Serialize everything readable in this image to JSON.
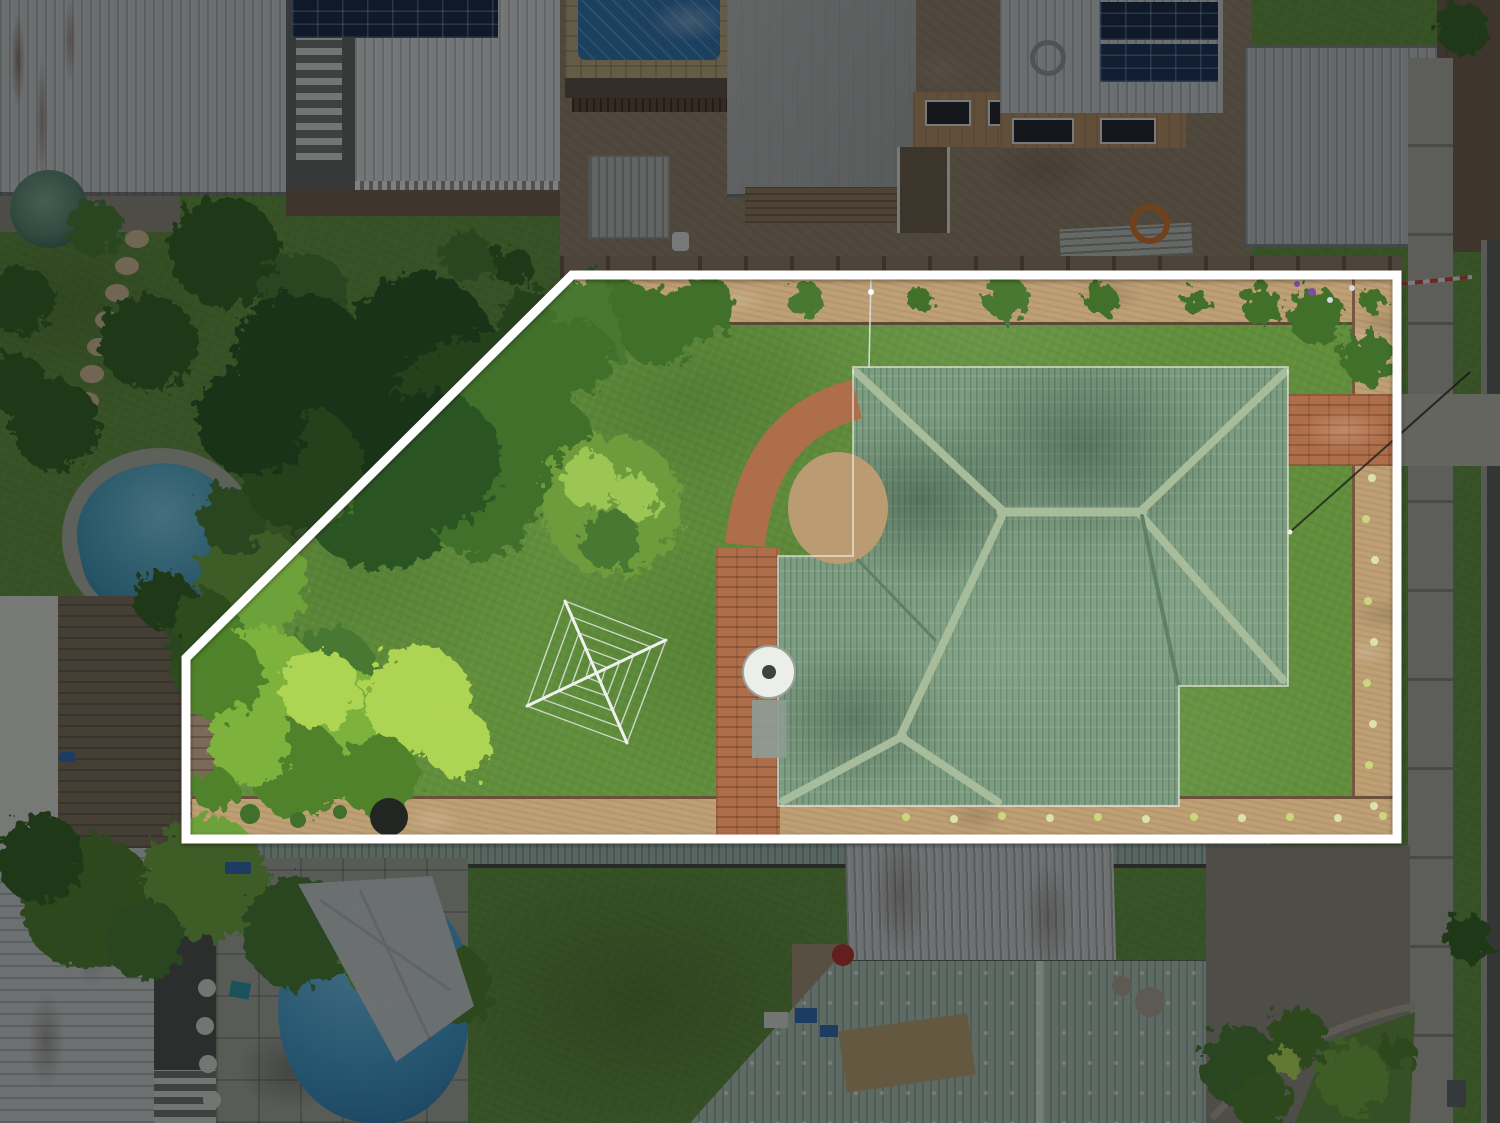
{
  "scene": {
    "type": "aerial-drone-photograph",
    "subject": "top-down real-estate aerial of a suburban lot outlined in white; large lawn with trees, rotary clothesline, green tiled hip-roof house, brick paths, neighbouring houses, two swimming pools, footpath and road at right; area outside the outline is dimmed"
  },
  "canvas": {
    "width": 1500,
    "height": 1123
  },
  "palette": {
    "boundary_white": "#ffffff",
    "dim": "rgba(7,10,14,0.46)",
    "lawn_base": "#618f3c",
    "canopy_dark": "#2c5420",
    "canopy_mid": "#41702c",
    "tree_round": "#6e9c3e",
    "tree_hl": "#9cc653",
    "bush_bright": "#7db23e",
    "bush_hl": "#aed452",
    "bush_mid": "#4f8229",
    "palm_dark": "#355f22",
    "palm_mid": "#487831",
    "veg_bright_out": "#6da23a",
    "veg_mid_out": "#4e7c2c",
    "roof_tile": "#7d9d81",
    "roof_ridge": "#a6bc9b",
    "roof_valley": "#5e8068",
    "white_roof_a": "#c0c2c3",
    "white_roof_b": "#cfd1d1",
    "white_roof_weathered": "#c4c6c6",
    "gray_roof": "#a8a9a7",
    "shed_gray": "#b4b8b8",
    "green_roof_pale": "#a8bcae",
    "carport_green": "#9db3a7",
    "solar_dark": "#18253f",
    "solar_line": "rgba(130,160,215,0.45)",
    "brick": "#ae6e4a",
    "mulch": "#bfa075",
    "dirt": "#8f7c64",
    "dirt_dark": "#6e5c48",
    "concrete": "#a6a399",
    "concrete_light": "#b5b2a7",
    "pavers": "#9fa096",
    "road": "#5c5c59",
    "curb": "#a09e95",
    "pool_teal_hi": "#79c4dc",
    "pool_teal": "#3f93b2",
    "pool_blue_hi": "#6fc0e4",
    "pool_blue": "#3c8fc0",
    "tarp_blue": "#2e6ea6",
    "deck_wood": "#7a6a57",
    "wall_white": "#d6d6d1",
    "tank_green": "#55806c",
    "timber_tan": "#b08a60",
    "window_dark": "#20242a",
    "fence_brown": "#8a7660",
    "sail_gray": "#c3c6c7",
    "clothesline": "#dfe5e1",
    "dish_white": "#eceeea",
    "orange": "#cc6f2a",
    "tape_red": "#c23b30",
    "stone_edge": "#a79e8e",
    "bbq_dark": "#232523",
    "flower_a": "#dce3a8",
    "flower_b": "#cbd67e",
    "flower_purple": "#7a4f9e",
    "flower_white": "#d9dade",
    "stone_tan": "#c9b48e",
    "pot_white": "#cfd0ca",
    "blue_item": "#2f66a8",
    "red_item": "#b03028"
  },
  "boundary": {
    "points": "572,275 1397,275 1397,839 186,839 186,658",
    "dim_path": "M0,0 H1500 V1123 H0 Z M572,275 L1397,275 L1397,839 L186,839 L186,658 Z"
  },
  "house_roof": {
    "gutter_points": "853,367 1288,367 1288,686 1179,686 1179,806 778,806 778,556 853,556"
  },
  "clothesline": {
    "outer": "565,601 666,640 627,743 527,706",
    "ring1": "572,617 651,647 620,727 542,699",
    "ring2": "579,633 634,654 613,711 558,691",
    "ring3": "585,648 620,661 607,696 572,684",
    "ring4": "591,661 606,667 601,683 586,677",
    "arm1": "M565,601 L627,743",
    "arm2": "M527,706 L666,640"
  },
  "paths": {
    "brick_curve": "M857,399 Q757,424 745,545",
    "stone_edge": "M1212,1118 Q1292,1030 1415,1006",
    "lawn_wedge": "1295,1123 1327,1043 1415,1012 1410,1123",
    "sail": "298,884 432,876 474,1006 396,1062",
    "wire_pole": "M871,276 L869,368",
    "wire_power": "M1290,532 L1470,372",
    "tape": "M1400,284 L1472,277"
  },
  "generated": [
    {
      "target": "#g-stones",
      "name": "stepping-stone",
      "shape": "ellipse",
      "attrs": [
        "cx",
        "cy",
        "rx",
        "ry",
        "fill"
      ],
      "items": [
        [
          137,
          239,
          12,
          9,
          "stone_tan"
        ],
        [
          127,
          266,
          12,
          9,
          "stone_tan"
        ],
        [
          117,
          293,
          12,
          9,
          "stone_tan"
        ],
        [
          107,
          320,
          12,
          9,
          "stone_tan"
        ],
        [
          99,
          347,
          12,
          9,
          "stone_tan"
        ],
        [
          92,
          374,
          12,
          9,
          "stone_tan"
        ],
        [
          87,
          401,
          12,
          9,
          "stone_tan"
        ],
        [
          84,
          428,
          12,
          9,
          "stone_tan"
        ]
      ]
    },
    {
      "target": "#g-veg",
      "name": "tree-canopy",
      "shape": "circle",
      "attrs": [
        "cx",
        "cy",
        "r",
        "fill"
      ],
      "items": [
        [
          225,
          252,
          55,
          "palm_dark"
        ],
        [
          305,
          298,
          45,
          "palm_mid"
        ],
        [
          148,
          342,
          48,
          "palm_dark"
        ],
        [
          55,
          425,
          45,
          "palm_dark"
        ],
        [
          95,
          228,
          28,
          "palm_mid"
        ],
        [
          20,
          300,
          34,
          "palm_dark"
        ],
        [
          15,
          382,
          30,
          "palm_dark"
        ],
        [
          468,
          258,
          26,
          "palm_mid"
        ],
        [
          512,
          266,
          20,
          "palm_dark"
        ],
        [
          252,
          582,
          55,
          "veg_bright_out"
        ],
        [
          330,
          672,
          46,
          "palm_mid"
        ],
        [
          205,
          638,
          40,
          "palm_mid"
        ],
        [
          232,
          520,
          34,
          "palm_mid"
        ],
        [
          165,
          600,
          30,
          "palm_dark"
        ],
        [
          88,
          902,
          68,
          "veg_mid_out"
        ],
        [
          205,
          878,
          62,
          "veg_bright_out"
        ],
        [
          298,
          933,
          56,
          "palm_mid"
        ],
        [
          388,
          952,
          50,
          "veg_bright_out"
        ],
        [
          452,
          986,
          40,
          "veg_mid_out"
        ],
        [
          40,
          858,
          44,
          "palm_dark"
        ],
        [
          145,
          940,
          40,
          "palm_mid"
        ],
        [
          1468,
          938,
          24,
          "palm_dark"
        ],
        [
          1462,
          28,
          26,
          "palm_dark"
        ],
        [
          1240,
          1066,
          40,
          "palm_mid"
        ],
        [
          1298,
          1038,
          30,
          "veg_mid_out"
        ],
        [
          1352,
          1078,
          36,
          "veg_bright_out"
        ],
        [
          1262,
          1100,
          30,
          "veg_mid_out"
        ],
        [
          1286,
          1062,
          14,
          "bush_hl"
        ],
        [
          1398,
          1052,
          16,
          "veg_mid_out"
        ],
        [
          360,
          418,
          88,
          "canopy_dark"
        ],
        [
          300,
          360,
          68,
          "canopy_dark"
        ],
        [
          420,
          348,
          74,
          "canopy_dark"
        ],
        [
          468,
          418,
          78,
          "canopy_mid"
        ],
        [
          380,
          488,
          82,
          "canopy_dark"
        ],
        [
          300,
          468,
          62,
          "canopy_mid"
        ],
        [
          252,
          420,
          55,
          "canopy_dark"
        ],
        [
          520,
          378,
          58,
          "canopy_mid"
        ],
        [
          545,
          448,
          52,
          "canopy_mid"
        ],
        [
          482,
          500,
          58,
          "canopy_mid"
        ],
        [
          430,
          460,
          70,
          "canopy_dark"
        ],
        [
          540,
          330,
          42,
          "canopy_mid"
        ],
        [
          600,
          318,
          48,
          "palm_mid"
        ],
        [
          658,
          328,
          38,
          "canopy_mid"
        ],
        [
          578,
          356,
          36,
          "canopy_mid"
        ],
        [
          700,
          310,
          30,
          "canopy_mid"
        ],
        [
          612,
          505,
          70,
          "tree_round"
        ],
        [
          590,
          480,
          28,
          "tree_hl"
        ],
        [
          636,
          496,
          22,
          "tree_hl"
        ],
        [
          610,
          540,
          30,
          "palm_mid"
        ],
        [
          262,
          688,
          60,
          "bush_bright"
        ],
        [
          340,
          733,
          66,
          "bush_bright"
        ],
        [
          418,
          700,
          54,
          "bush_hl"
        ],
        [
          298,
          770,
          48,
          "bush_mid"
        ],
        [
          218,
          675,
          44,
          "bush_mid"
        ],
        [
          378,
          776,
          40,
          "bush_mid"
        ],
        [
          458,
          743,
          34,
          "bush_hl"
        ],
        [
          250,
          745,
          40,
          "bush_bright"
        ],
        [
          205,
          622,
          32,
          "bush_mid"
        ],
        [
          320,
          690,
          40,
          "bush_hl"
        ],
        [
          215,
          790,
          22,
          "bush_mid"
        ],
        [
          628,
          300,
          20,
          "canopy_mid"
        ],
        [
          718,
          296,
          14,
          "canopy_mid"
        ],
        [
          806,
          300,
          18,
          "palm_mid"
        ],
        [
          920,
          300,
          12,
          "canopy_mid"
        ],
        [
          1006,
          298,
          22,
          "palm_mid"
        ],
        [
          1102,
          300,
          16,
          "canopy_mid"
        ],
        [
          1196,
          302,
          13,
          "canopy_mid"
        ],
        [
          1262,
          306,
          20,
          "canopy_mid"
        ],
        [
          1316,
          316,
          28,
          "canopy_mid"
        ],
        [
          1368,
          358,
          26,
          "canopy_mid"
        ],
        [
          1372,
          300,
          12,
          "canopy_mid"
        ]
      ]
    },
    {
      "target": "#g-ridges",
      "name": "roof-ridge",
      "shape": "path",
      "attrs": [
        "d",
        "stroke",
        "stroke-width"
      ],
      "items": [
        [
          "M856,372 L1004,512",
          "roof_ridge",
          8
        ],
        [
          "M1285,372 L1140,512",
          "roof_ridge",
          8
        ],
        [
          "M1001,512 L1143,512",
          "roof_ridge",
          9
        ],
        [
          "M1140,514 L1283,680",
          "roof_ridge",
          8
        ],
        [
          "M1003,514 L901,735",
          "roof_ridge",
          8
        ],
        [
          "M903,736 L783,801",
          "roof_ridge",
          8
        ],
        [
          "M901,737 L998,802",
          "roof_ridge",
          8
        ],
        [
          "M1142,516 L1178,684",
          "roof_valley",
          4
        ],
        [
          "M858,560 L935,640",
          "roof_valley",
          3
        ]
      ]
    },
    {
      "target": "#g-flowers",
      "name": "garden-flower",
      "shape": "circle",
      "attrs": [
        "cx",
        "cy",
        "r",
        "fill"
      ],
      "items": [
        [
          1372,
          478,
          4,
          "flower_a"
        ],
        [
          1366,
          519,
          4,
          "flower_b"
        ],
        [
          1375,
          560,
          4,
          "flower_a"
        ],
        [
          1368,
          601,
          4,
          "flower_b"
        ],
        [
          1374,
          642,
          4,
          "flower_a"
        ],
        [
          1367,
          683,
          4,
          "flower_b"
        ],
        [
          1373,
          724,
          4,
          "flower_a"
        ],
        [
          1369,
          765,
          4,
          "flower_b"
        ],
        [
          1374,
          806,
          4,
          "flower_a"
        ],
        [
          906,
          817,
          4,
          "flower_b"
        ],
        [
          954,
          819,
          4,
          "flower_a"
        ],
        [
          1002,
          816,
          4,
          "flower_b"
        ],
        [
          1050,
          818,
          4,
          "flower_a"
        ],
        [
          1098,
          817,
          4,
          "flower_b"
        ],
        [
          1146,
          819,
          4,
          "flower_a"
        ],
        [
          1194,
          817,
          4,
          "flower_b"
        ],
        [
          1242,
          818,
          4,
          "flower_a"
        ],
        [
          1290,
          817,
          4,
          "flower_b"
        ],
        [
          1338,
          818,
          4,
          "flower_a"
        ],
        [
          1383,
          816,
          4,
          "flower_b"
        ],
        [
          1312,
          292,
          4,
          "flower_purple"
        ],
        [
          1330,
          300,
          3,
          "flower_white"
        ],
        [
          1297,
          284,
          3,
          "flower_purple"
        ],
        [
          1352,
          288,
          3,
          "flower_white"
        ],
        [
          250,
          814,
          10,
          "canopy_mid"
        ],
        [
          298,
          820,
          8,
          "canopy_mid"
        ],
        [
          340,
          812,
          7,
          "canopy_mid"
        ]
      ]
    },
    {
      "target": "#g-objs",
      "name": "yard-object",
      "shape": "circle",
      "attrs": [
        "cx",
        "cy",
        "r",
        "fill"
      ],
      "items": [
        [
          207,
          988,
          9,
          "pot_white"
        ],
        [
          205,
          1026,
          9,
          "pot_white"
        ],
        [
          208,
          1064,
          9,
          "pot_white"
        ],
        [
          212,
          1100,
          9,
          "pot_white"
        ],
        [
          1150,
          1002,
          15,
          "stone_edge"
        ],
        [
          1122,
          986,
          10,
          "stone_edge"
        ],
        [
          389,
          817,
          19,
          "bbq_dark"
        ],
        [
          843,
          955,
          11,
          "red_item"
        ]
      ]
    },
    {
      "target": "#g-bits",
      "name": "yard-item",
      "shape": "rect",
      "attrs": [
        "x",
        "y",
        "width",
        "height",
        "fill",
        "transform"
      ],
      "items": [
        [
          795,
          1008,
          22,
          15,
          "blue_item",
          ""
        ],
        [
          820,
          1025,
          18,
          12,
          "blue_item",
          ""
        ],
        [
          764,
          1012,
          24,
          16,
          "pot_white",
          ""
        ],
        [
          842,
          1022,
          130,
          62,
          "#b59a6d",
          "rotate(-8 907 1053)"
        ],
        [
          225,
          862,
          26,
          12,
          "blue_item",
          ""
        ],
        [
          1447,
          1080,
          19,
          27,
          "#5e6162",
          ""
        ],
        [
          230,
          982,
          20,
          16,
          "#2a8f9e",
          "rotate(10 240 990)"
        ]
      ]
    }
  ]
}
